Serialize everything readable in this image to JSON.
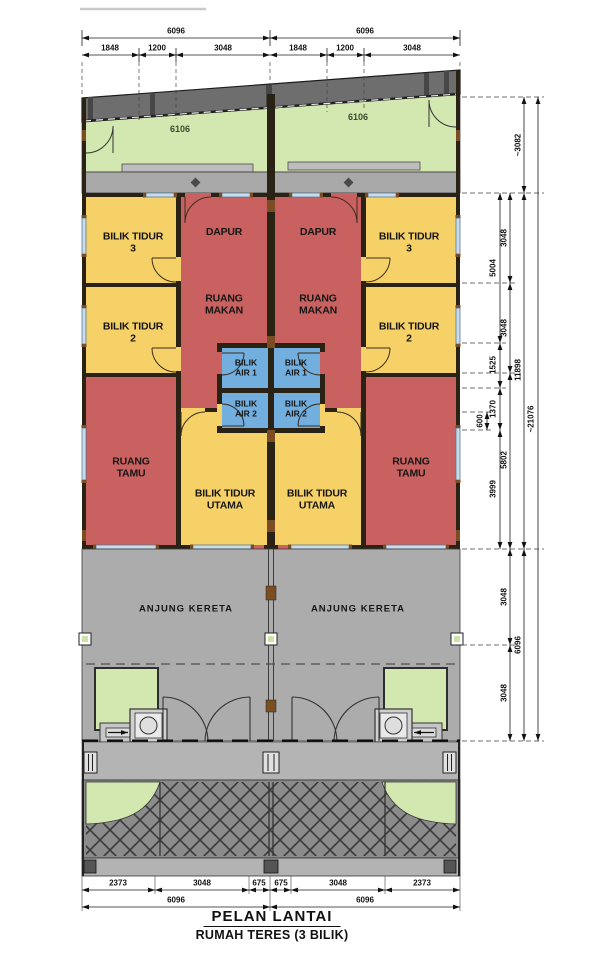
{
  "title": {
    "name": "PELAN LANTAI",
    "subtitle": "RUMAH TERES (3 BILIK)"
  },
  "rooms": {
    "bilik_tidur_3": "BILIK TIDUR\n3",
    "bilik_tidur_2": "BILIK TIDUR\n2",
    "dapur": "DAPUR",
    "ruang_makan": "RUANG\nMAKAN",
    "bilik_air_1": "BILIK\nAIR 1",
    "bilik_air_2": "BILIK\nAIR 2",
    "ruang_tamu": "RUANG\nTAMU",
    "bilik_tidur_utama": "BILIK TIDUR\nUTAMA",
    "anjung_kereta": "ANJUNG KERETA"
  },
  "dims": {
    "top_overall": [
      "6096",
      "6096"
    ],
    "top_sub": [
      "1848",
      "1200",
      "3048",
      "1848",
      "1200",
      "3048"
    ],
    "yard": [
      "6106",
      "6106"
    ],
    "right_rooms": [
      "5004",
      "1525",
      "1370",
      "3999"
    ],
    "right_small": "600",
    "right_zones": [
      "3048",
      "3048",
      "5802",
      "3048",
      "3048"
    ],
    "right_groups": [
      "~3082",
      "11898",
      "6096"
    ],
    "right_total": "~21076",
    "bottom_sub": [
      "2373",
      "3048",
      "675",
      "675",
      "3048",
      "2373"
    ],
    "bottom_overall": [
      "6096",
      "6096"
    ]
  },
  "colors": {
    "room_red": "#c96160",
    "room_yellow": "#f6d168",
    "room_blue": "#72aede",
    "yard_green": "#d3e7b0",
    "porch_gray": "#acacac",
    "roof_gray": "#6e6e6e",
    "apron_gray": "#8b8b8b",
    "wall_dark": "#2b2216",
    "wall_brown": "#7a4e22"
  }
}
